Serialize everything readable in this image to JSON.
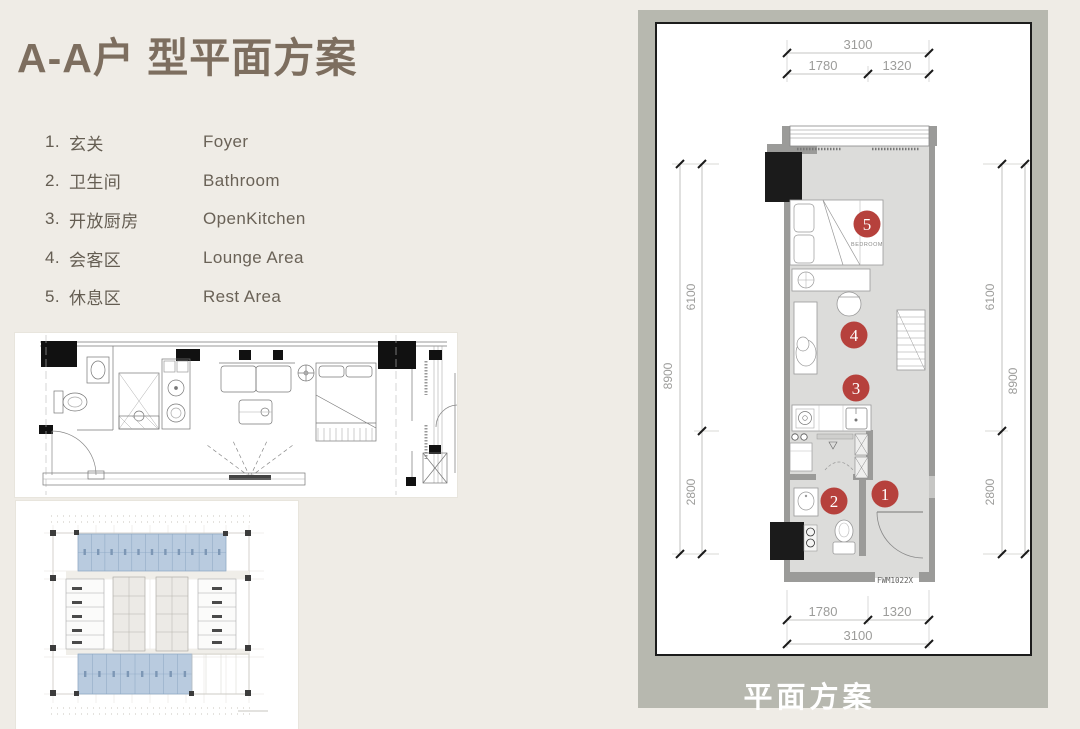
{
  "page": {
    "title": "A-A户 型平面方案"
  },
  "legend": {
    "items": [
      {
        "num": "1.",
        "zh": "玄关",
        "en": "Foyer"
      },
      {
        "num": "2.",
        "zh": "卫生间",
        "en": "Bathroom"
      },
      {
        "num": "3.",
        "zh": "开放厨房",
        "en": "OpenKitchen"
      },
      {
        "num": "4.",
        "zh": "会客区",
        "en": "Lounge Area"
      },
      {
        "num": "5.",
        "zh": "休息区",
        "en": "Rest Area"
      }
    ]
  },
  "plan_panel": {
    "caption": "平面方案",
    "room_label": "BEDROOM",
    "unit_code": "FWM1022X",
    "markers": [
      "1",
      "2",
      "3",
      "4",
      "5"
    ],
    "dims": {
      "top_total": "3100",
      "top_left": "1780",
      "top_right": "1320",
      "bottom_left": "1780",
      "bottom_right": "1320",
      "bottom_total": "3100",
      "left_total": "8900",
      "left_upper": "6100",
      "left_lower": "2800",
      "right_total": "8900",
      "right_upper": "6100",
      "right_lower": "2800"
    },
    "colors": {
      "panel_gray": "#b7b8af",
      "marker_red": "#b6413c",
      "wall_gray": "#9b9b99",
      "floor_gray": "#dcdcda",
      "highlight_blue": "#b9cbdf"
    }
  }
}
